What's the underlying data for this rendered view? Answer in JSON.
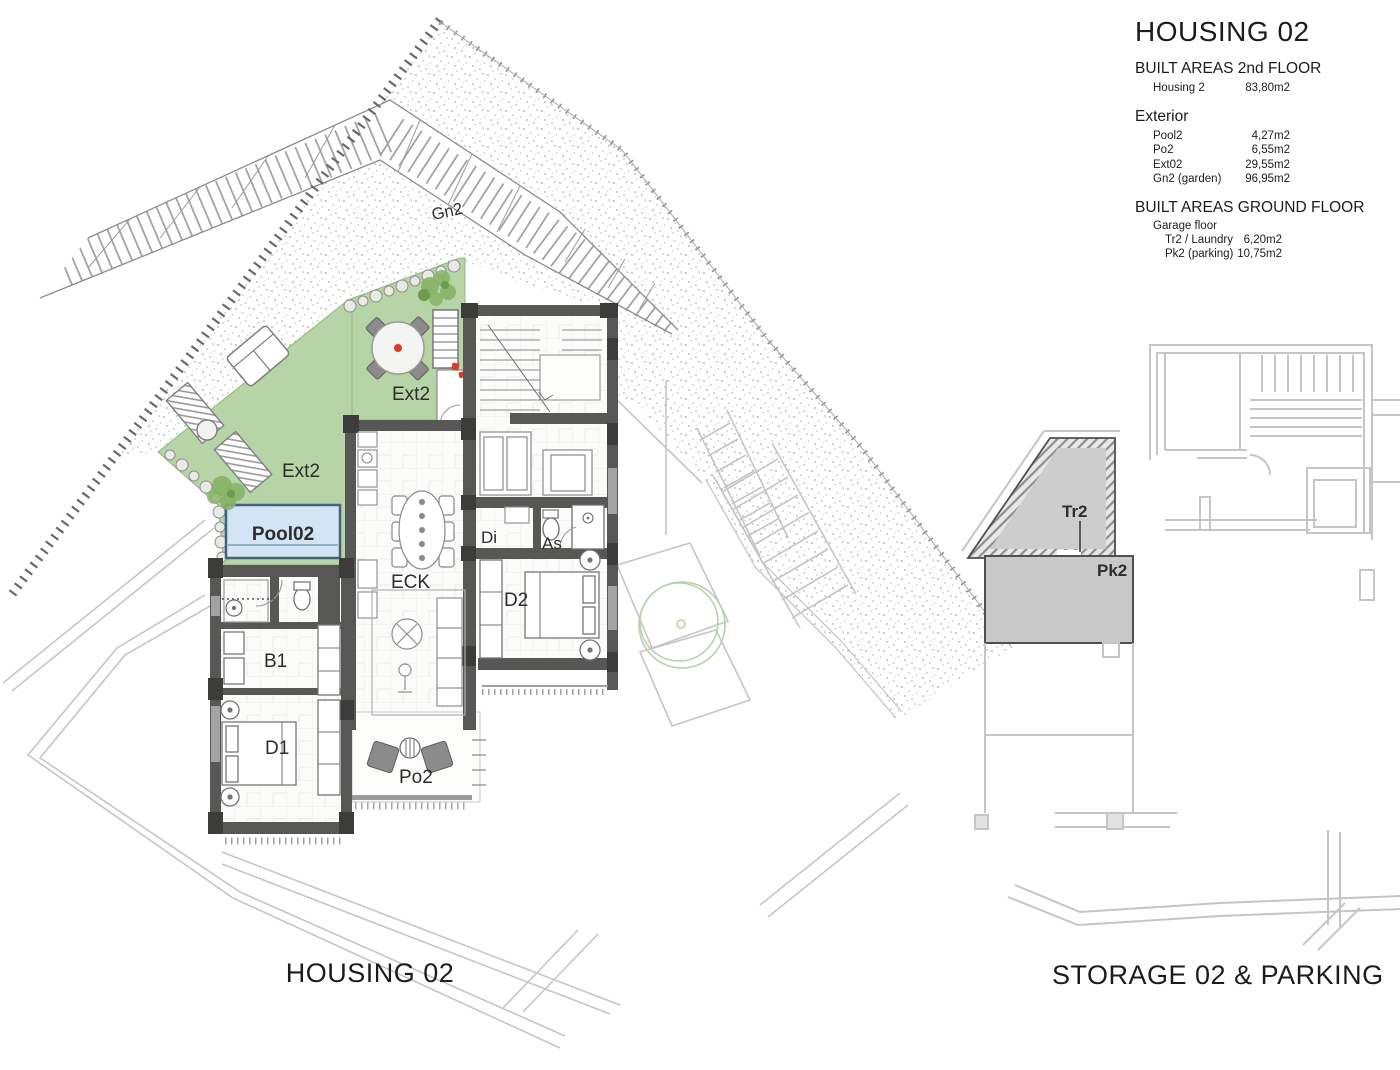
{
  "legend": {
    "title": "HOUSING 02",
    "sections": [
      {
        "heading": "BUILT AREAS 2nd FLOOR",
        "rows": [
          {
            "label": "Housing 2",
            "value": "83,80m2"
          }
        ]
      },
      {
        "heading": "Exterior",
        "rows": [
          {
            "label": "Pool2",
            "value": "4,27m2"
          },
          {
            "label": "Po2",
            "value": "6,55m2"
          },
          {
            "label": "Ext02",
            "value": "29,55m2"
          },
          {
            "label": "Gn2 (garden)",
            "value": "96,95m2"
          }
        ]
      },
      {
        "heading": "BUILT AREAS GROUND FLOOR",
        "subheading": "Garage floor",
        "rows": [
          {
            "label": "Tr2 / Laundry",
            "value": "6,20m2"
          },
          {
            "label": "Pk2 (parking)",
            "value": "10,75m2"
          }
        ]
      }
    ]
  },
  "plan_labels": {
    "garden": "Gn2",
    "terrace_upper": "Ext2",
    "terrace_lower": "Ext2",
    "pool": "Pool02",
    "living": "ECK",
    "hall": "Di",
    "bath2": "As",
    "bedroom2": "D2",
    "bath1": "B1",
    "bedroom1": "D1",
    "porch": "Po2"
  },
  "storage_labels": {
    "laundry": "Tr2",
    "parking": "Pk2"
  },
  "captions": {
    "housing": "HOUSING 02",
    "storage": "STORAGE 02 & PARKING"
  },
  "colors": {
    "wall": "#575756",
    "column": "#3c3c3b",
    "terrace_green": "#b6d4a6",
    "tree_green": "#85b164",
    "pool_fill": "#d3e5f5",
    "pool_border": "#44617e",
    "context_gray": "#c5c5c5",
    "highlight_gray": "#c9c9c9",
    "accent_red": "#d93b2b"
  }
}
